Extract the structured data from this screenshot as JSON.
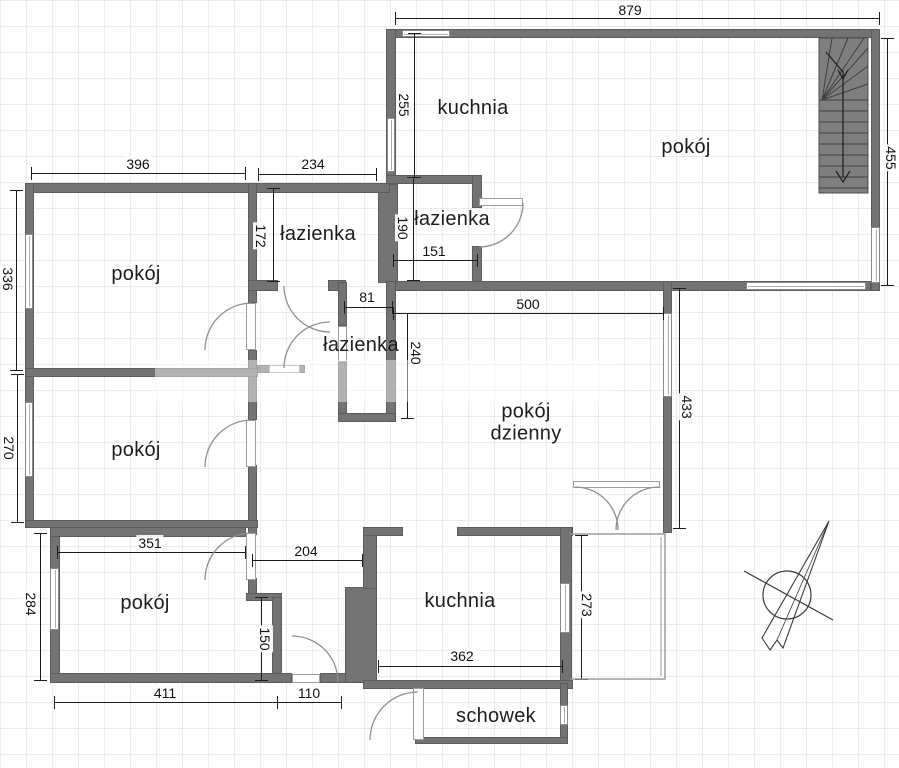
{
  "plan": {
    "type": "floorplan",
    "rooms": [
      {
        "id": "kuchnia-top",
        "label": "kuchnia"
      },
      {
        "id": "pokoj-top-right",
        "label": "pokój"
      },
      {
        "id": "lazienka-top-left",
        "label": "łazienka"
      },
      {
        "id": "lazienka-top-right",
        "label": "łazienka"
      },
      {
        "id": "pokoj-1",
        "label": "pokój"
      },
      {
        "id": "lazienka-middle",
        "label": "łazienka"
      },
      {
        "id": "pokoj-dzienny",
        "label_line1": "pokój",
        "label_line2": "dzienny"
      },
      {
        "id": "pokoj-2",
        "label": "pokój"
      },
      {
        "id": "pokoj-3",
        "label": "pokój"
      },
      {
        "id": "kuchnia-bottom",
        "label": "kuchnia"
      },
      {
        "id": "schowek",
        "label": "schowek"
      }
    ],
    "dimensions": [
      {
        "id": "top-total-width",
        "value": "879"
      },
      {
        "id": "pokoj1-width",
        "value": "396"
      },
      {
        "id": "lazienka-left-width",
        "value": "234"
      },
      {
        "id": "kuchnia-top-depth",
        "value": "255"
      },
      {
        "id": "lazienka-left-height",
        "value": "172"
      },
      {
        "id": "lazienka-right-height",
        "value": "190"
      },
      {
        "id": "lazienka-right-width",
        "value": "151"
      },
      {
        "id": "lazienka-middle-width",
        "value": "81"
      },
      {
        "id": "pokoj-dzienny-width",
        "value": "500"
      },
      {
        "id": "right-section-height",
        "value": "455"
      },
      {
        "id": "pokoj1-height",
        "value": "336"
      },
      {
        "id": "pokoj2-height",
        "value": "270"
      },
      {
        "id": "hall-depth",
        "value": "240"
      },
      {
        "id": "pokoj-dzienny-height",
        "value": "433"
      },
      {
        "id": "pokoj3-width-top",
        "value": "351"
      },
      {
        "id": "hall-width",
        "value": "204"
      },
      {
        "id": "pokoj3-height",
        "value": "284"
      },
      {
        "id": "niche-height",
        "value": "150"
      },
      {
        "id": "balcony-height",
        "value": "273"
      },
      {
        "id": "kuchnia-bottom-width",
        "value": "362"
      },
      {
        "id": "pokoj3-width-bottom",
        "value": "411"
      },
      {
        "id": "corridor-width",
        "value": "110"
      }
    ],
    "features": [
      "stairs",
      "compass-rose",
      "balcony-outline",
      "door-arcs",
      "windows"
    ],
    "colors": {
      "wall": "#737373",
      "wall_edge": "#5c5c5c",
      "dimension_text": "#111111",
      "room_text": "#1d1d1d",
      "door_arc": "#8f8f8f",
      "grid": "#ececec",
      "stairs_fill": "#7e7e7e"
    }
  }
}
